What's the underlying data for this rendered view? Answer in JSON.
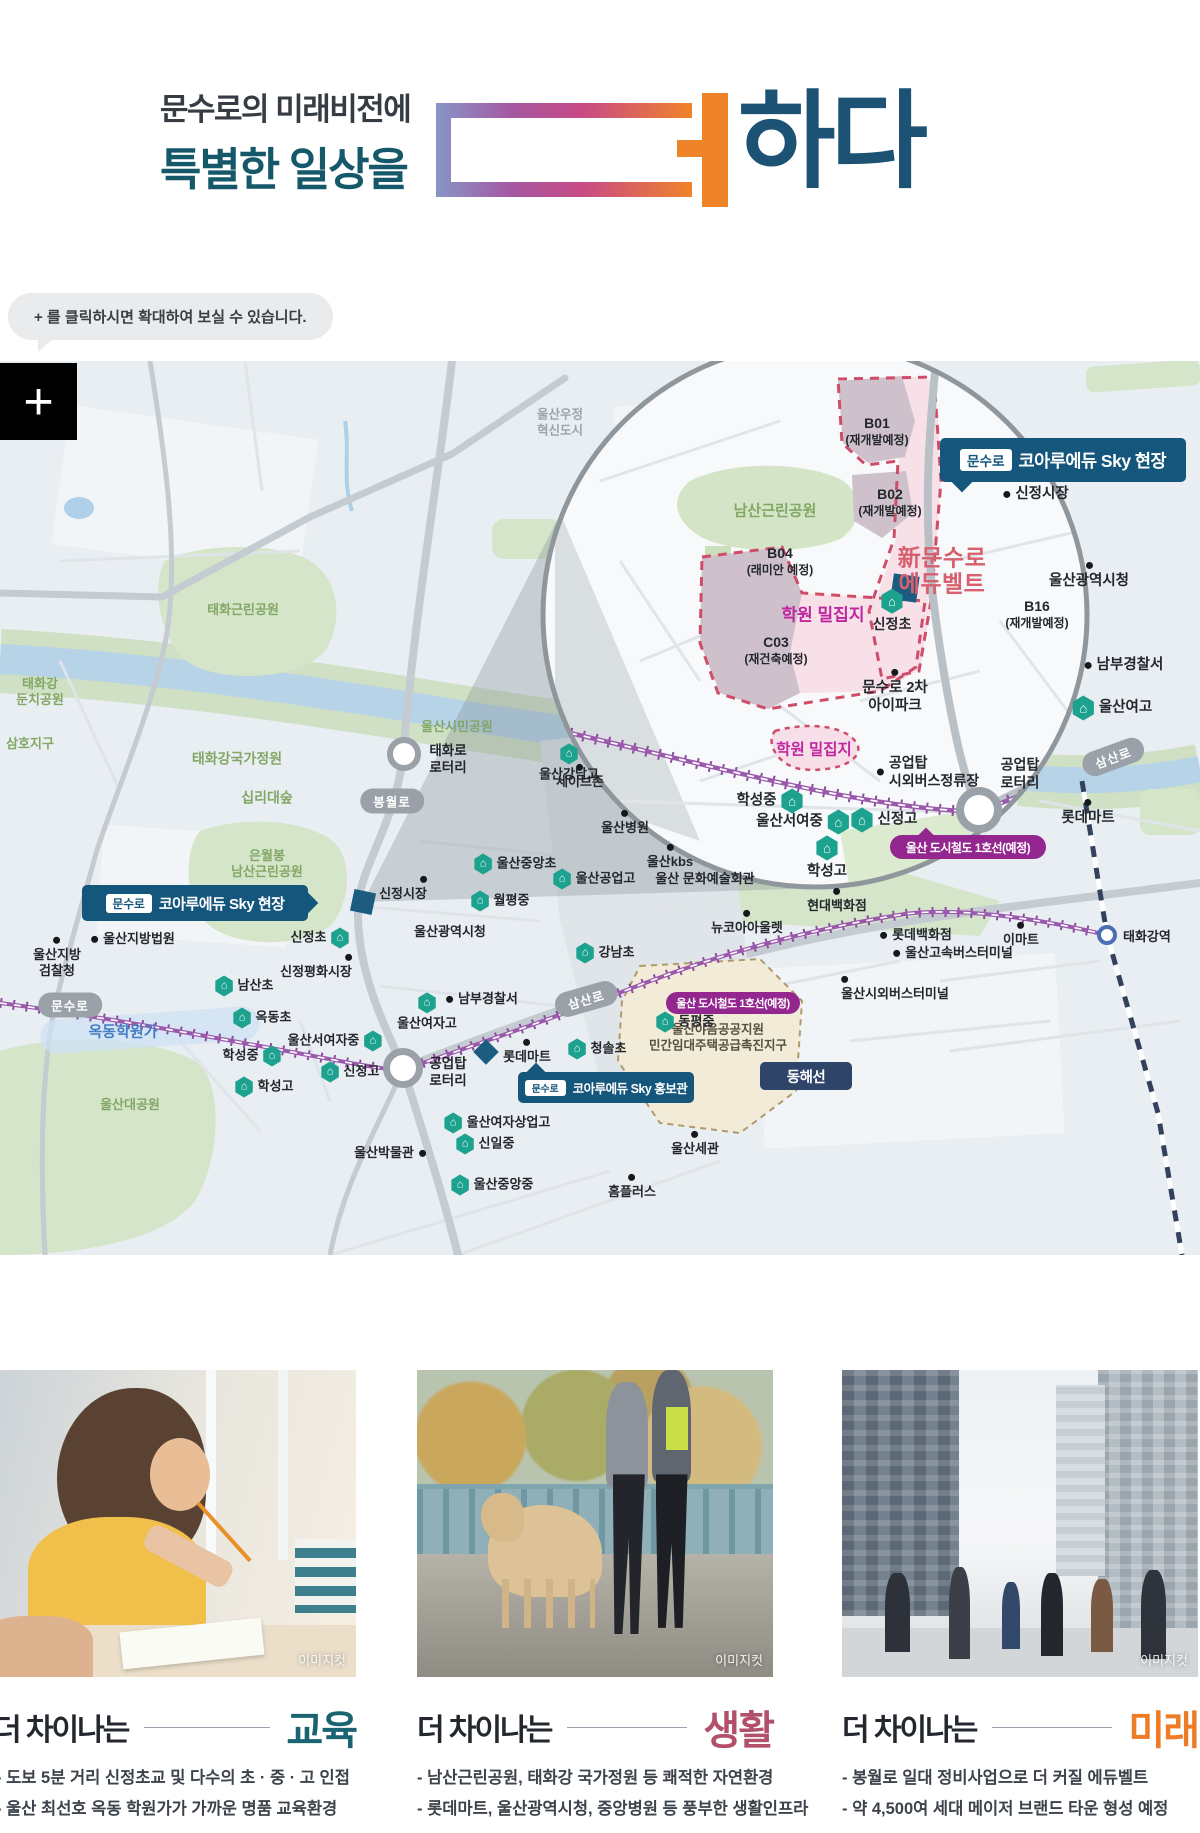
{
  "header": {
    "line1": "문수로의 미래비전에",
    "line2": "특별한 일상을",
    "logo_suffix": "하다",
    "accent_teal": "#14586a",
    "accent_navy": "#1c5274",
    "accent_orange": "#ef8329"
  },
  "tooltip": {
    "text": "+ 를 클릭하시면 확대하여 보실 수 있습니다."
  },
  "map": {
    "zoom_button_label": "+",
    "points": [
      {
        "n": "park-taehwa-neighborhood",
        "t": "park",
        "x": 243,
        "y": 249,
        "l": "태화근린공원"
      },
      {
        "n": "park-taehwagang-dunchi",
        "t": "park",
        "x": 40,
        "y": 331,
        "l": "태화강\n둔치공원"
      },
      {
        "n": "park-samho-district",
        "t": "park",
        "x": 30,
        "y": 383,
        "l": "삼호지구"
      },
      {
        "n": "park-taehwagang-national-garden",
        "t": "park",
        "x": 237,
        "y": 398,
        "l": "태화강국가정원",
        "fs": 14
      },
      {
        "n": "park-simnidaesup",
        "t": "park",
        "x": 267,
        "y": 437,
        "l": "십리대숲",
        "fs": 14
      },
      {
        "n": "park-eunwolbong-namsan",
        "t": "park",
        "x": 267,
        "y": 503,
        "l": "은월봉\n남산근린공원"
      },
      {
        "n": "park-ulsan-citizen",
        "t": "park",
        "x": 457,
        "y": 366,
        "l": "울산시민공원"
      },
      {
        "n": "park-ulsan-grand",
        "t": "park",
        "x": 130,
        "y": 744,
        "l": "울산대공원"
      },
      {
        "n": "label-ulsan-ujeong-innovation-city",
        "t": "gray",
        "x": 560,
        "y": 62,
        "l": "울산우정\n혁신도시",
        "fs": 12.5
      },
      {
        "n": "label-taehwaro-rotary",
        "t": "plain",
        "x": 448,
        "y": 399,
        "l": "태화로\n로터리",
        "fs": 13.5,
        "al": "l"
      },
      {
        "n": "label-gongeuptap-rotary-main",
        "t": "plain",
        "x": 448,
        "y": 712,
        "l": "공업탑\n로터리",
        "fs": 13.5,
        "al": "l"
      },
      {
        "n": "poi-ulsan-district-court",
        "t": "dot",
        "d": "l",
        "x": 133,
        "y": 578,
        "l": "울산지방법원"
      },
      {
        "n": "poi-ulsan-district-prosecutors",
        "t": "dot",
        "d": "t",
        "x": 57,
        "y": 597,
        "l": "울산지방\n검찰청"
      },
      {
        "n": "poi-sinjeong-peace-market",
        "t": "dot",
        "d": "tr",
        "x": 316,
        "y": 606,
        "l": "신정평화시장"
      },
      {
        "n": "label-ulsan-city-hall-main",
        "t": "plain",
        "x": 450,
        "y": 571,
        "l": "울산광역시청"
      },
      {
        "n": "poi-sinjeong-market-main",
        "t": "dot",
        "d": "tr",
        "x": 403,
        "y": 528,
        "l": "신정시장"
      },
      {
        "n": "label-ulsan-culture-art-center",
        "t": "plain",
        "x": 705,
        "y": 518,
        "l": "울산 문화예술회관"
      },
      {
        "n": "poi-ulsan-hospital",
        "t": "dot",
        "d": "t",
        "x": 625,
        "y": 462,
        "l": "울산병원"
      },
      {
        "n": "poi-ulsan-kbs",
        "t": "dot",
        "d": "t",
        "x": 670,
        "y": 496,
        "l": "울산kbs"
      },
      {
        "n": "poi-savezone",
        "t": "dot",
        "d": "t",
        "x": 580,
        "y": 416,
        "l": "세이브존"
      },
      {
        "n": "poi-nambu-police-main",
        "t": "dot",
        "d": "l",
        "x": 482,
        "y": 638,
        "l": "남부경찰서"
      },
      {
        "n": "poi-lottemart-main",
        "t": "dot",
        "d": "t",
        "x": 527,
        "y": 691,
        "l": "롯데마트"
      },
      {
        "n": "poi-ulsan-museum",
        "t": "dot",
        "d": "r",
        "x": 390,
        "y": 792,
        "l": "울산박물관"
      },
      {
        "n": "poi-homeplus",
        "t": "dot",
        "d": "t",
        "x": 632,
        "y": 826,
        "l": "홈플러스"
      },
      {
        "n": "poi-ulsan-customs",
        "t": "dot",
        "d": "t",
        "x": 695,
        "y": 783,
        "l": "울산세관"
      },
      {
        "n": "poi-hyundai-dept",
        "t": "dot",
        "d": "b",
        "x": 837,
        "y": 540,
        "l": "현대백화점"
      },
      {
        "n": "poi-newcore-outlet",
        "t": "dot",
        "d": "b",
        "x": 747,
        "y": 562,
        "l": "뉴코아아울렛"
      },
      {
        "n": "poi-lotte-dept",
        "t": "dot",
        "d": "l",
        "x": 916,
        "y": 574,
        "l": "롯데백화점"
      },
      {
        "n": "poi-emart",
        "t": "dot",
        "d": "b",
        "x": 1021,
        "y": 574,
        "l": "이마트"
      },
      {
        "n": "poi-ulsan-express-bus-terminal",
        "t": "dot",
        "d": "l",
        "x": 953,
        "y": 592,
        "l": "울산고속버스터미널"
      },
      {
        "n": "poi-ulsan-intercity-bus-terminal",
        "t": "dot",
        "d": "tl",
        "x": 895,
        "y": 628,
        "l": "울산시외버스터미널"
      },
      {
        "n": "label-yaeum-public-housing-district",
        "t": "tan",
        "x": 718,
        "y": 677,
        "l": "울산야음공공지원\n민간임대주택공급촉진지구"
      },
      {
        "n": "label-okdong-academy-street",
        "t": "blue",
        "x": 123,
        "y": 672,
        "l": "옥동학원가"
      },
      {
        "n": "school-ulsan-gangnam-high",
        "t": "school",
        "i": "t",
        "x": 569,
        "y": 402,
        "l": "울산강남고"
      },
      {
        "n": "school-ulsan-jungang-elem",
        "t": "school",
        "i": "l",
        "x": 515,
        "y": 503,
        "l": "울산중앙초"
      },
      {
        "n": "school-ulsan-technical-high",
        "t": "school",
        "i": "l",
        "x": 594,
        "y": 518,
        "l": "울산공업고"
      },
      {
        "n": "school-wolpyeong-middle",
        "t": "school",
        "i": "l",
        "x": 500,
        "y": 540,
        "l": "월평중"
      },
      {
        "n": "school-namsan-elem",
        "t": "school",
        "i": "l",
        "x": 244,
        "y": 625,
        "l": "남산초"
      },
      {
        "n": "school-okdong-elem",
        "t": "school",
        "i": "l",
        "x": 262,
        "y": 657,
        "l": "옥동초"
      },
      {
        "n": "school-ulsan-seo-girls-middle",
        "t": "school",
        "i": "r",
        "x": 335,
        "y": 680,
        "l": "울산서여자중"
      },
      {
        "n": "school-hakseong-middle-main",
        "t": "school",
        "i": "r",
        "x": 252,
        "y": 695,
        "l": "학성중"
      },
      {
        "n": "school-sinjeong-high-main",
        "t": "school",
        "i": "l",
        "x": 350,
        "y": 711,
        "l": "신정고"
      },
      {
        "n": "school-hakseong-high-main",
        "t": "school",
        "i": "l",
        "x": 264,
        "y": 726,
        "l": "학성고"
      },
      {
        "n": "school-ulsan-girls-high-main",
        "t": "school",
        "i": "t",
        "x": 427,
        "y": 651,
        "l": "울산여자고"
      },
      {
        "n": "school-gangnam-elem",
        "t": "school",
        "i": "l",
        "x": 605,
        "y": 592,
        "l": "강남초"
      },
      {
        "n": "school-cheongsol-elem",
        "t": "school",
        "i": "l",
        "x": 597,
        "y": 688,
        "l": "청솔초"
      },
      {
        "n": "school-dongpyeong-middle",
        "t": "school",
        "i": "l",
        "x": 685,
        "y": 661,
        "l": "동평중"
      },
      {
        "n": "school-ulsan-girls-commercial-high",
        "t": "school",
        "i": "l",
        "x": 497,
        "y": 762,
        "l": "울산여자상업고"
      },
      {
        "n": "school-sinil-middle",
        "t": "school",
        "i": "l",
        "x": 485,
        "y": 783,
        "l": "신일중"
      },
      {
        "n": "school-ulsan-jungang-middle",
        "t": "school",
        "i": "l",
        "x": 492,
        "y": 824,
        "l": "울산중앙중"
      },
      {
        "n": "school-sinjeong-elem-main",
        "t": "school",
        "i": "r",
        "x": 320,
        "y": 577,
        "l": "신정초"
      },
      {
        "n": "park-namsan-inset",
        "t": "park",
        "x": 775,
        "y": 151,
        "l": "남산근린공원",
        "fs": 15
      },
      {
        "n": "zone-b01",
        "t": "zone",
        "x": 877,
        "y": 70,
        "l": "B01",
        "s": "(재개발예정)"
      },
      {
        "n": "zone-b02",
        "t": "zone",
        "x": 890,
        "y": 141,
        "l": "B02",
        "s": "(재개발예정)"
      },
      {
        "n": "zone-b04",
        "t": "zone",
        "x": 780,
        "y": 200,
        "l": "B04",
        "s": "(래미안 예정)"
      },
      {
        "n": "zone-c03",
        "t": "zone",
        "x": 776,
        "y": 289,
        "l": "C03",
        "s": "(재건축예정)"
      },
      {
        "n": "zone-b16",
        "t": "zone",
        "x": 1037,
        "y": 253,
        "l": "B16",
        "s": "(재개발예정)"
      },
      {
        "n": "label-new-munsuro-edubelt",
        "t": "bigpink",
        "x": 942,
        "y": 210,
        "l": "新문수로\n에듀벨트"
      },
      {
        "n": "label-hakwon-miljipji-1",
        "t": "magenta",
        "x": 823,
        "y": 254,
        "l": "학원 밀집지"
      },
      {
        "n": "label-hakwon-miljipji-2",
        "t": "magenta",
        "x": 814,
        "y": 389,
        "l": "학원 밀집지",
        "fs": 15.5
      },
      {
        "n": "school-sinjeong-elem-inset",
        "t": "school",
        "i": "t",
        "x": 892,
        "y": 250,
        "l": "신정초",
        "fs": 14
      },
      {
        "n": "poi-sinjeong-market-inset",
        "t": "dot",
        "d": "l",
        "x": 1036,
        "y": 133,
        "l": "신정시장",
        "fs": 14.5
      },
      {
        "n": "poi-ulsan-city-hall-inset",
        "t": "dot",
        "d": "b",
        "x": 1089,
        "y": 215,
        "l": "울산광역시청",
        "fs": 14.5
      },
      {
        "n": "poi-nambu-police-inset",
        "t": "dot",
        "d": "l",
        "x": 1124,
        "y": 304,
        "l": "남부경찰서",
        "fs": 14.5
      },
      {
        "n": "school-ulsan-girls-high-inset",
        "t": "school",
        "i": "l",
        "x": 1112,
        "y": 347,
        "l": "울산여고",
        "fs": 14.5
      },
      {
        "n": "poi-munsuro-2cha-ipark",
        "t": "dot",
        "d": "t",
        "x": 895,
        "y": 331,
        "l": "문수로 2차\n아이파크",
        "fs": 14.5
      },
      {
        "n": "poi-gongeuptap-bus-stop",
        "t": "dot",
        "d": "l",
        "x": 928,
        "y": 411,
        "l": "공업탑\n시외버스정류장",
        "fs": 14,
        "al": "l"
      },
      {
        "n": "label-gongeuptap-rotary-inset",
        "t": "plain",
        "x": 1020,
        "y": 413,
        "l": "공업탑\n로터리",
        "fs": 14,
        "al": "l"
      },
      {
        "n": "poi-lottemart-inset",
        "t": "dot",
        "d": "t",
        "x": 1088,
        "y": 452,
        "l": "롯데마트",
        "fs": 14.5
      },
      {
        "n": "school-hakseong-middle-inset",
        "t": "school",
        "i": "r",
        "x": 770,
        "y": 440,
        "l": "학성중",
        "fs": 14.5
      },
      {
        "n": "school-ulsan-seo-girls-middle-inset",
        "t": "school",
        "i": "r",
        "x": 803,
        "y": 461,
        "l": "울산서여중",
        "fs": 14.5
      },
      {
        "n": "school-sinjeong-high-inset",
        "t": "school",
        "i": "l",
        "x": 884,
        "y": 459,
        "l": "신정고",
        "fs": 14.5
      },
      {
        "n": "school-hakseong-high-inset",
        "t": "school",
        "i": "t",
        "x": 827,
        "y": 497,
        "l": "학성고",
        "fs": 14.5
      }
    ],
    "pills": [
      {
        "n": "road-bongwolro",
        "x": 392,
        "y": 440,
        "l": "봉월로",
        "rot": 0
      },
      {
        "n": "road-munsuro",
        "x": 70,
        "y": 644,
        "l": "문수로",
        "rot": 0
      },
      {
        "n": "road-samsanro-main",
        "x": 586,
        "y": 638,
        "l": "삼산로",
        "rot": -16
      },
      {
        "n": "road-samsanro-inset",
        "x": 1113,
        "y": 396,
        "l": "삼산로",
        "rot": -20
      }
    ],
    "badges": [
      {
        "n": "site-hyeonjang-inset",
        "kind": "navy",
        "x": 940,
        "y": 77,
        "w": 246,
        "h": 44,
        "fs": 17.5,
        "prefix": "문수로",
        "l": "코아루에듀 Sky 현장",
        "ptr": "bl"
      },
      {
        "n": "site-hyeonjang-main",
        "kind": "navy",
        "x": 82,
        "y": 524,
        "w": 226,
        "h": 36,
        "fs": 15,
        "prefix": "문수로",
        "l": "코아루에듀 Sky 현장",
        "ptr": "r"
      },
      {
        "n": "site-hongbogwan",
        "kind": "navy",
        "x": 518,
        "y": 711,
        "w": 176,
        "h": 31,
        "fs": 12.5,
        "prefix": "문수로",
        "l": "코아루에듀 Sky 홍보관",
        "ptr": "tl"
      },
      {
        "n": "metro-line1-main",
        "kind": "purple",
        "x": 666,
        "y": 631,
        "w": 134,
        "h": 22,
        "fs": 11,
        "l": "울산 도시철도 1호선(예정)"
      },
      {
        "n": "metro-line1-inset",
        "kind": "purple",
        "x": 890,
        "y": 474,
        "w": 156,
        "h": 24,
        "fs": 12,
        "l": "울산 도시철도 1호선(예정)",
        "ptr": "t"
      },
      {
        "n": "donghae-line",
        "kind": "slate",
        "x": 760,
        "y": 701,
        "w": 92,
        "h": 28,
        "fs": 14.5,
        "l": "동해선"
      }
    ],
    "rotaries": [
      {
        "n": "taehwaro-rotary-node",
        "x": 404,
        "y": 393,
        "r": 11,
        "bw": 6
      },
      {
        "n": "gongeuptap-rotary-node",
        "x": 403,
        "y": 707,
        "r": 13,
        "bw": 7
      },
      {
        "n": "gongeuptap-rotary-node-inset",
        "x": 979,
        "y": 449,
        "r": 15,
        "bw": 8
      }
    ],
    "station": {
      "n": "taehwagang-station",
      "x": 1117,
      "y": 574,
      "l": "태화강역"
    }
  },
  "cards": [
    {
      "caption_prefix": "더 차이나는",
      "keyword": "교육",
      "color": "#1a6472",
      "imagecut": "이미지컷",
      "bullets": [
        "- 도보 5분 거리 신정초교 및 다수의 초 · 중 · 고 인접",
        "- 울산 최선호 옥동 학원가가 가까운 명품 교육환경"
      ]
    },
    {
      "caption_prefix": "더 차이나는",
      "keyword": "생활",
      "color": "#b2506b",
      "imagecut": "이미지컷",
      "bullets": [
        "- 남산근린공원, 태화강 국가정원 등 쾌적한 자연환경",
        "- 롯데마트, 울산광역시청, 중앙병원 등 풍부한 생활인프라"
      ]
    },
    {
      "caption_prefix": "더 차이나는",
      "keyword": "미래",
      "color": "#ee7c26",
      "imagecut": "이미지컷",
      "bullets": [
        "- 봉월로 일대 정비사업으로 더 커질 에듀벨트",
        "- 약 4,500여 세대 메이저 브랜드 타운 형성 예정"
      ]
    }
  ]
}
